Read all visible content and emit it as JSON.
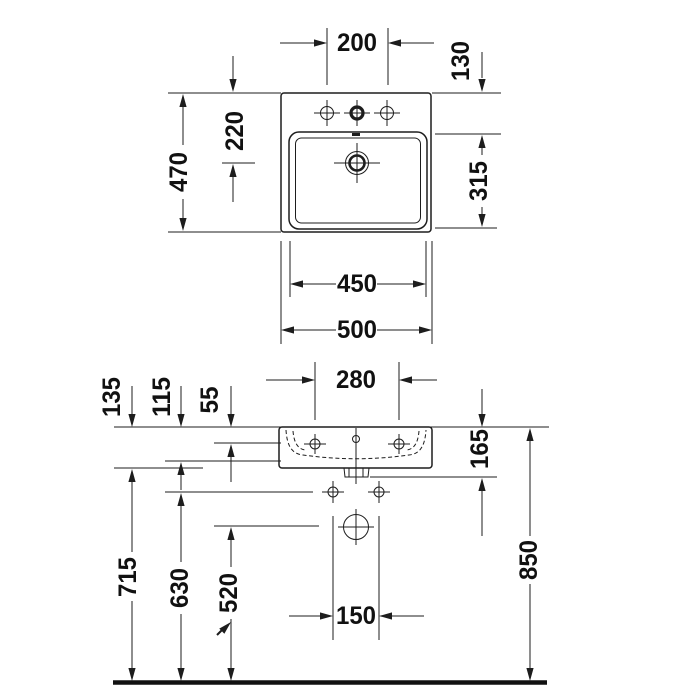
{
  "colors": {
    "line": "#1d1d1d",
    "background": "#ffffff"
  },
  "plan": {
    "tap_spacing": "200",
    "rim_to_basin": "130",
    "rim_to_drain": "220",
    "depth": "470",
    "basin_depth": "315",
    "basin_width": "450",
    "width": "500"
  },
  "front": {
    "anchor_spacing": "280",
    "body_height": "135",
    "rim_to_basin_floor": "115",
    "rim_to_fixing": "55",
    "rim_to_underside": "165",
    "floor_to_rim": "850",
    "floor_to_body_bottom": "715",
    "floor_to_lower_holes": "630",
    "floor_to_drain": "520",
    "lower_hole_spacing": "150"
  }
}
